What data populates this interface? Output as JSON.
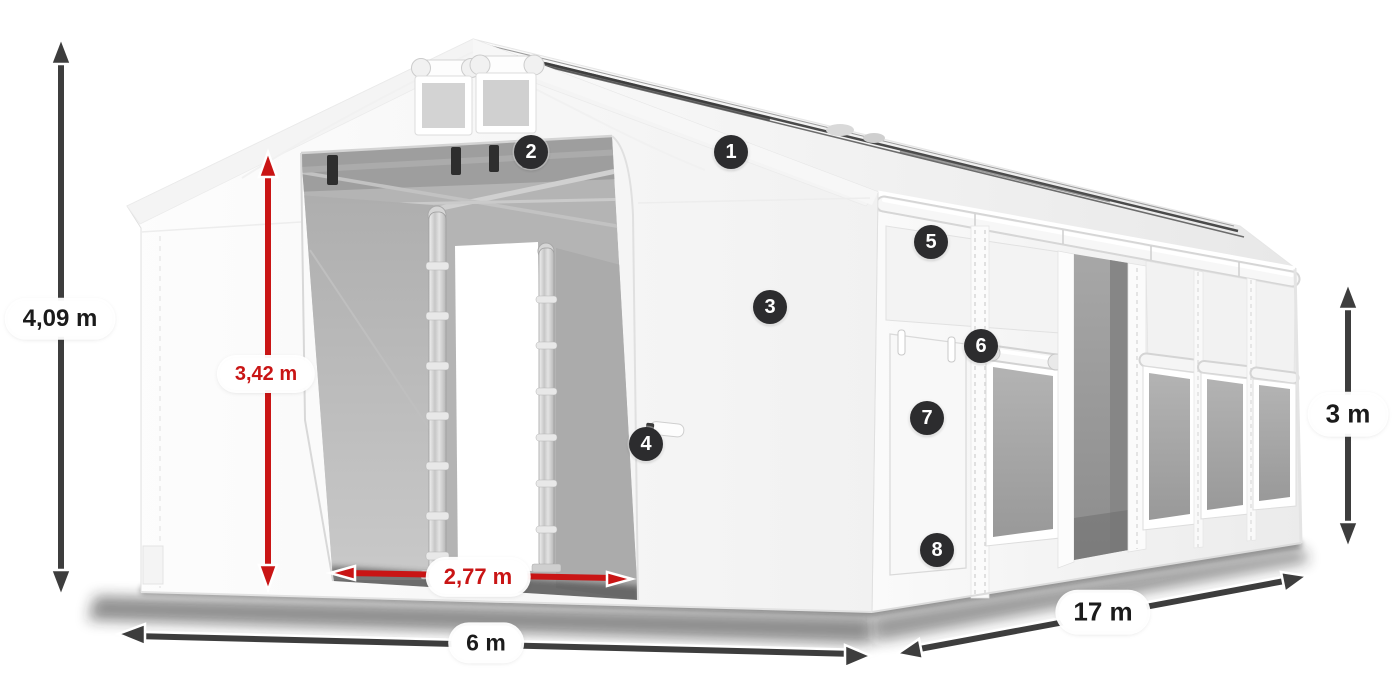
{
  "dimensions": {
    "total_height": {
      "label": "4,09 m",
      "style": "dark",
      "orientation": "vertical"
    },
    "entrance_height": {
      "label": "3,42 m",
      "style": "red",
      "orientation": "vertical"
    },
    "entrance_width": {
      "label": "2,77 m",
      "style": "red",
      "orientation": "horizontal"
    },
    "front_width": {
      "label": "6 m",
      "style": "dark",
      "orientation": "horizontal"
    },
    "side_length": {
      "label": "17 m",
      "style": "dark",
      "orientation": "diagonal"
    },
    "side_height": {
      "label": "3 m",
      "style": "dark",
      "orientation": "vertical"
    }
  },
  "callouts": [
    {
      "number": "1"
    },
    {
      "number": "2"
    },
    {
      "number": "3"
    },
    {
      "number": "4"
    },
    {
      "number": "5"
    },
    {
      "number": "6"
    },
    {
      "number": "7"
    },
    {
      "number": "8"
    }
  ],
  "colors": {
    "dimension_red": "#c91515",
    "arrow_dark": "#3d3d3d",
    "badge_background": "#2c2c2e",
    "badge_text": "#ffffff",
    "background": "#ffffff"
  }
}
